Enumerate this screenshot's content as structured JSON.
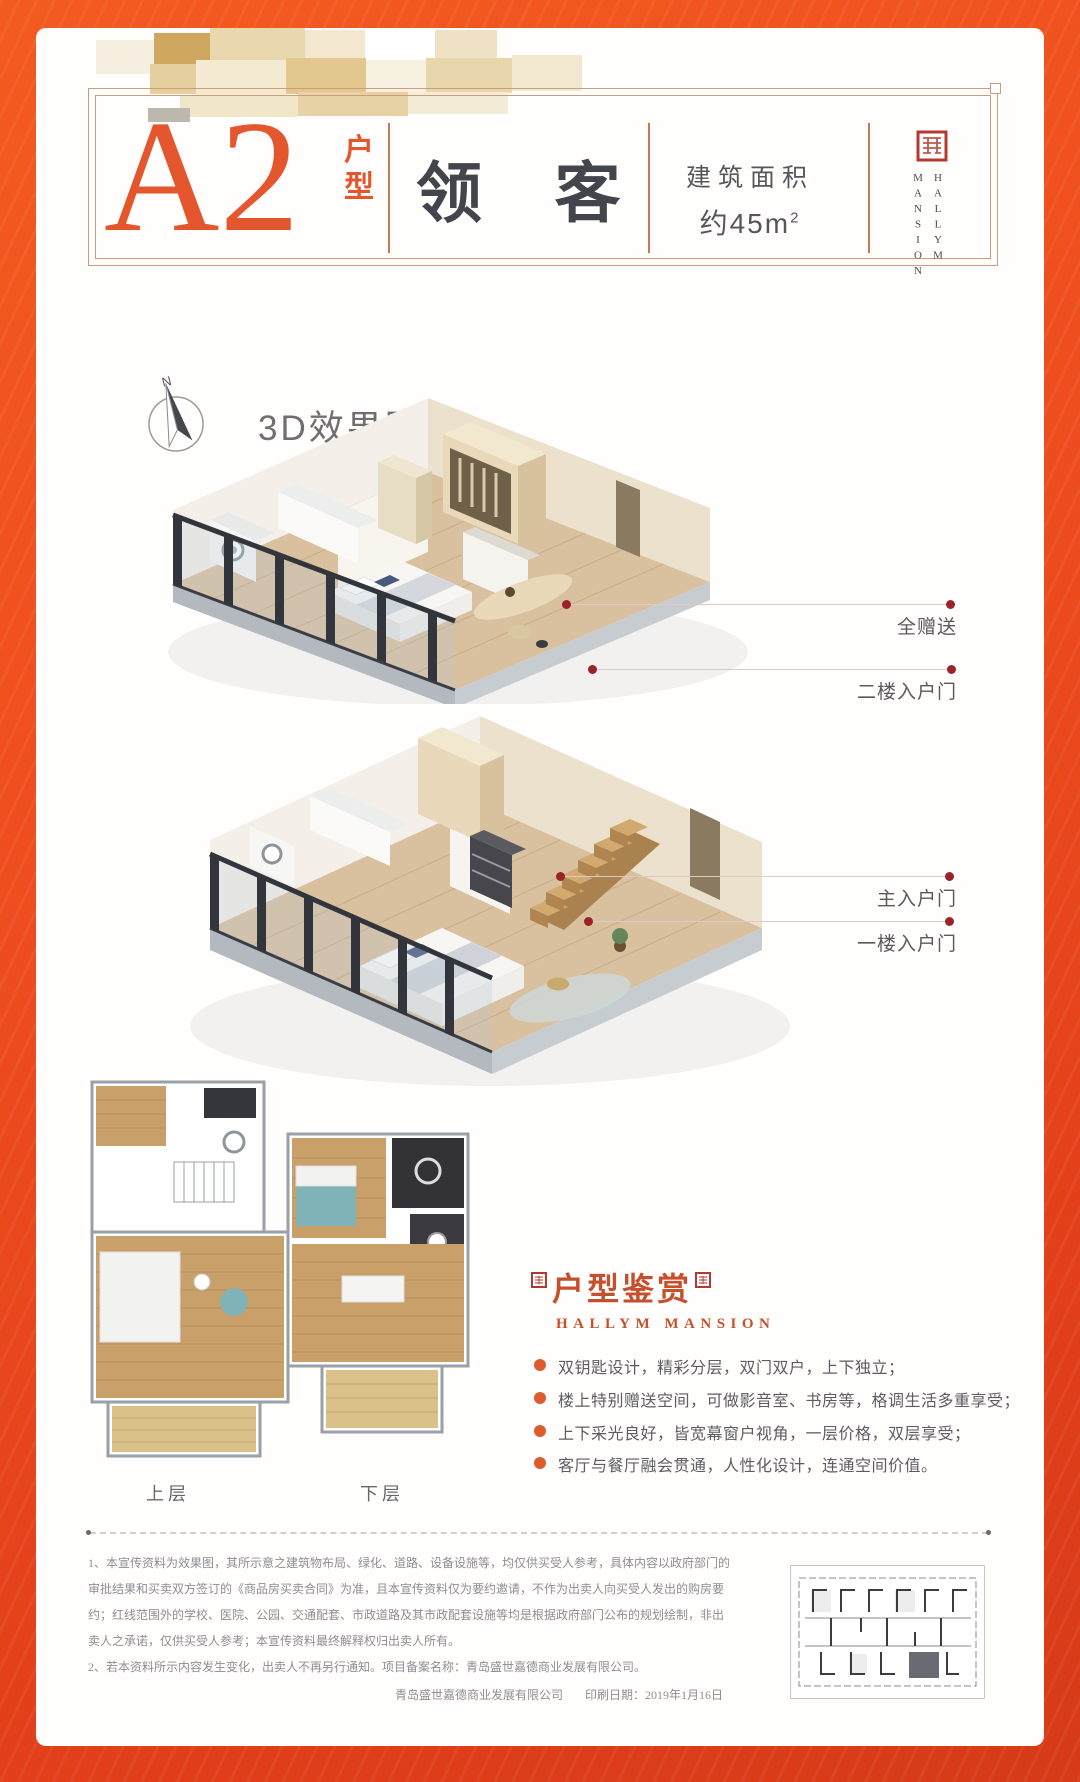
{
  "header": {
    "unit_code": "A2",
    "unit_type": "户型",
    "unit_name": "领 客",
    "area_label": "建筑面积",
    "area_value": "约45m",
    "area_sup": "2",
    "brand_left": "MANSION",
    "brand_right": "HALLYM"
  },
  "render_section": {
    "title": "3D效果图",
    "compass_n": "N",
    "callouts": [
      "全赠送",
      "二楼入户门",
      "主入户门",
      "一楼入户门"
    ]
  },
  "plans": {
    "upper_label": "上层",
    "lower_label": "下层"
  },
  "appreciation": {
    "title": "户型鉴赏",
    "subtitle": "HALLYM MANSION",
    "bullets": [
      "双钥匙设计，精彩分层，双门双户，上下独立；",
      "楼上特别赠送空间，可做影音室、书房等，格调生活多重享受；",
      "上下采光良好，皆宽幕窗户视角，一层价格，双层享受；",
      "客厅与餐厅融会贯通，人性化设计，连通空间价值。"
    ]
  },
  "disclaimer": {
    "lines": [
      "1、本宣传资料为效果图，其所示意之建筑物布局、绿化、道路、设备设施等，均仅供买受人参考，具体内容以政府部门的",
      "审批结果和买卖双方签订的《商品房买卖合同》为准，且本宣传资料仅为要约邀请，不作为出卖人向买受人发出的购房要",
      "约；红线范围外的学校、医院、公园、交通配套、市政道路及其市政配套设施等均是根据政府部门公布的规划绘制，非出",
      "卖人之承诺，仅供买受人参考；本宣传资料最终解释权归出卖人所有。",
      "2、若本资料所示内容发生变化，出卖人不再另行通知。项目备案名称：青岛盛世嘉德商业发展有限公司。"
    ],
    "footer_company": "青岛盛世嘉德商业发展有限公司",
    "footer_print": "印刷日期：2019年1月16日"
  },
  "colors": {
    "frame_orange": "#ee4d1e",
    "accent_orange": "#e4572e",
    "seal_red": "#b23a2e",
    "callout_dot": "#9b2226",
    "appreciation_red": "#c7502c"
  }
}
